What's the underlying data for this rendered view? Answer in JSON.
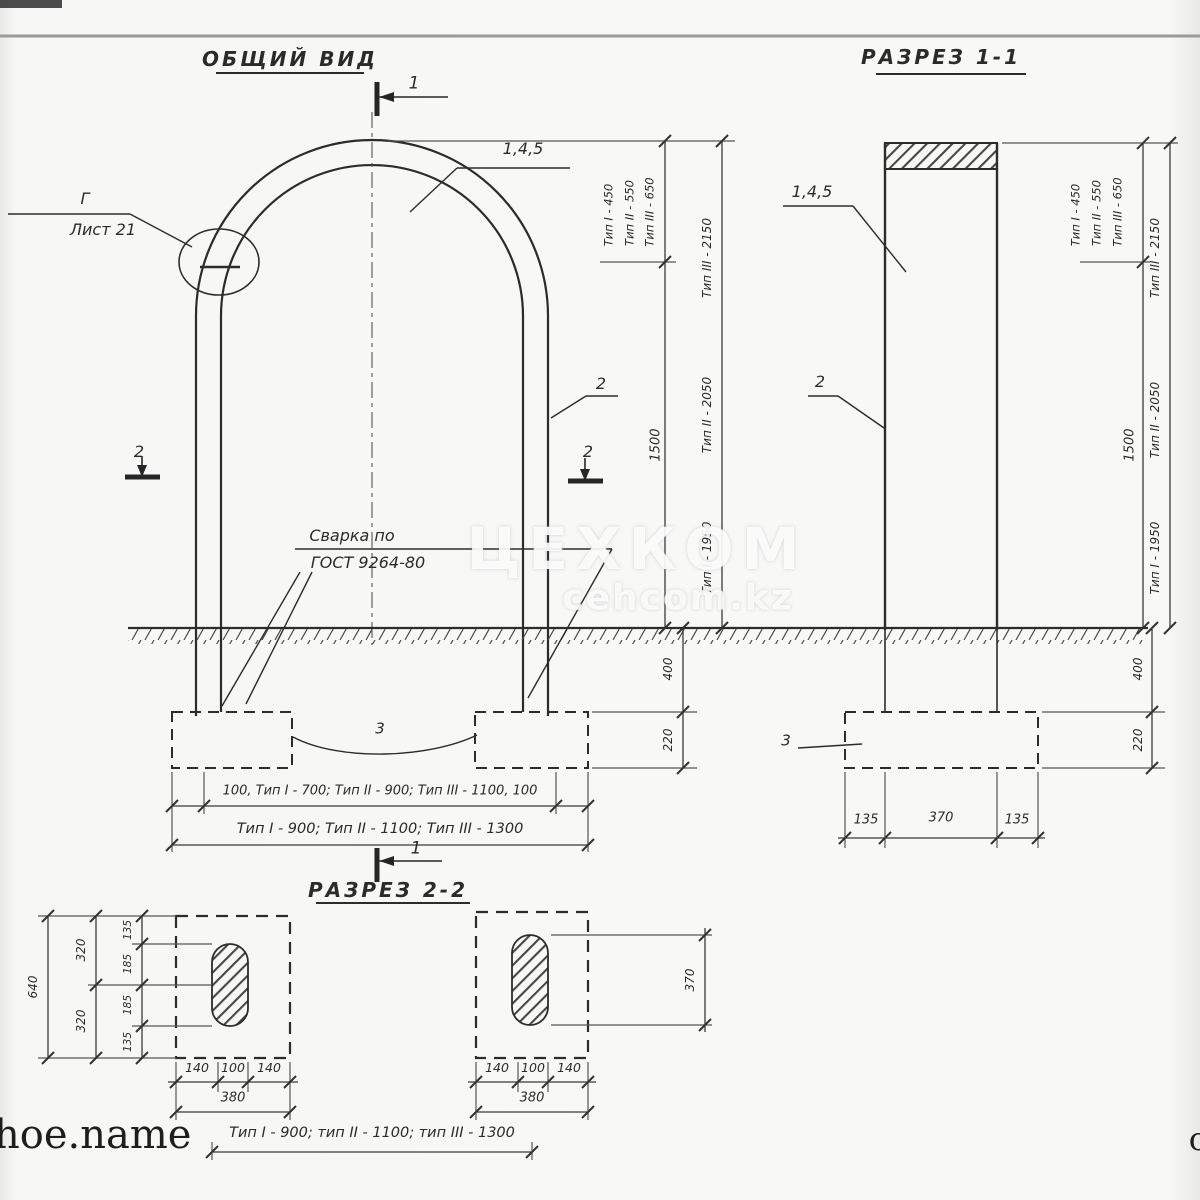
{
  "colors": {
    "ink": "#2c2c2c",
    "paper": "#f8f8f6",
    "watermark": "#ffffff"
  },
  "titles": {
    "general_view": "ОБЩИЙ ВИД",
    "section_1": "РАЗРЕЗ 1-1",
    "section_2": "РАЗРЕЗ 2-2"
  },
  "markers": {
    "cut1": "1",
    "cut2": "2"
  },
  "general_view": {
    "detail_ref": "Г",
    "detail_sheet": "Лист 21",
    "parts_arc": "1,4,5",
    "part_post": "2",
    "part_foundation": "3",
    "weld_line1": "Сварка по",
    "weld_line2": "ГОСТ 9264-80",
    "bottom_dim_inner": "100, Тип I - 700; Тип II - 900; Тип III - 1100, 100",
    "bottom_dim_outer": "Тип I - 900; Тип II - 1100; Тип III - 1300"
  },
  "height_dims": {
    "arc_t1": "Тип I - 450",
    "arc_t2": "Тип II - 550",
    "arc_t3": "Тип III - 650",
    "total_t3": "Тип III - 2150",
    "total_t2": "Тип II - 2050",
    "total_t1": "Тип I - 1950",
    "post": "1500",
    "below_ground": "400",
    "foundation_h": "220"
  },
  "section_1": {
    "parts_top": "1,4,5",
    "part_post": "2",
    "part_foundation": "3",
    "bottom_dims": [
      "135",
      "370",
      "135"
    ]
  },
  "section_2": {
    "plan_left": {
      "total_v": "640",
      "mid_v": [
        "320",
        "320"
      ],
      "inner_v": [
        "135",
        "185",
        "185",
        "135"
      ],
      "bottom": [
        "140",
        "100",
        "140"
      ],
      "bottom_total": "380"
    },
    "plan_right": {
      "slot_len": "370",
      "bottom": [
        "140",
        "100",
        "140"
      ],
      "bottom_total": "380"
    },
    "note": "Тип I - 900; тип II - 1100; тип III - 1300"
  },
  "watermarks": {
    "brand": "ЦЕХКОМ",
    "site": "cehcom.kz",
    "corner": "hoe.name",
    "edge": "о"
  }
}
